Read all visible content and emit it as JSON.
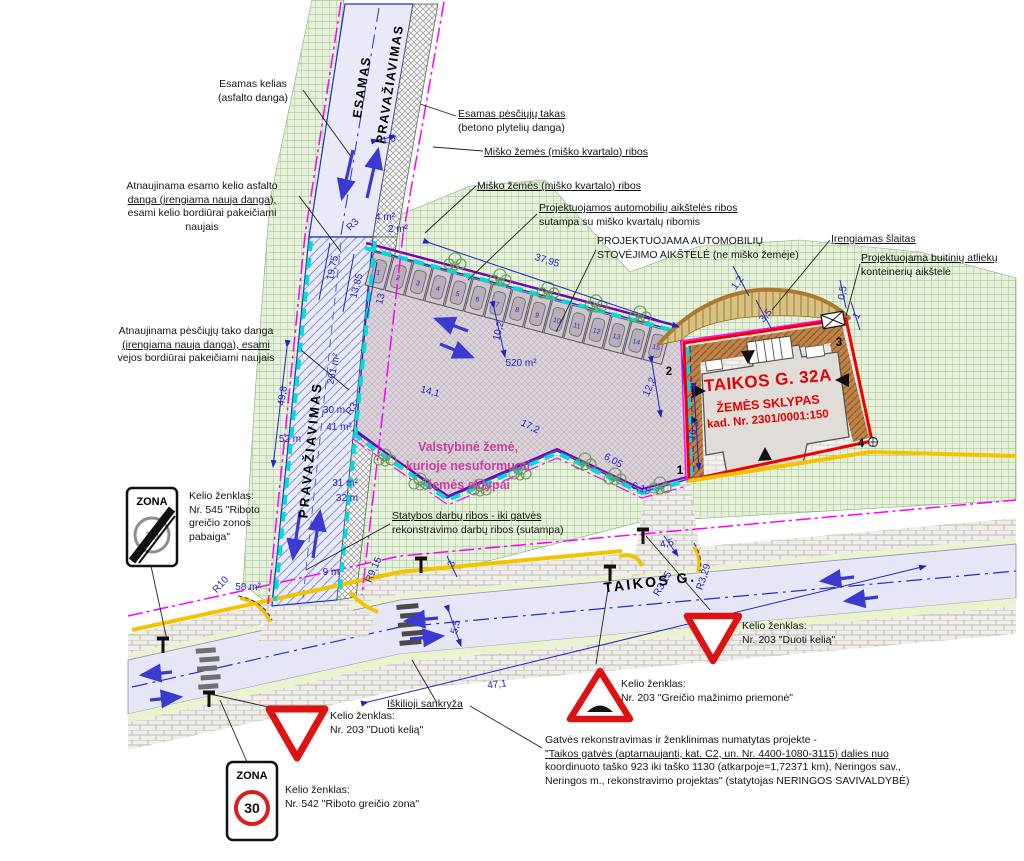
{
  "plot": {
    "title": "TAIKOS G. 32A",
    "subtitle": "ŽEMĖS SKLYPAS",
    "cadastre": "kad. Nr. 2301/0001:150",
    "corner_points": [
      "1",
      "2",
      "3",
      "4"
    ]
  },
  "signs": {
    "zone_end": {
      "title": "ZONA",
      "speed": "30"
    },
    "zone_30": {
      "title": "ZONA",
      "speed": "30"
    }
  },
  "parking": {
    "stall_count": 15,
    "stall_numbers": [
      "1",
      "2",
      "3",
      "4",
      "5",
      "6",
      "7",
      "8",
      "9",
      "10",
      "11",
      "12",
      "13",
      "14",
      "15"
    ],
    "area_label": "520 m²"
  },
  "annotations": [
    {
      "id": "esamas-kelias-label",
      "x": 253,
      "y": 78,
      "align": "center",
      "lines": [
        "Esamas kelias",
        "(asfalto danga)"
      ]
    },
    {
      "id": "esamas-takas-label",
      "x": 458,
      "y": 108,
      "ul": [
        0
      ],
      "lines": [
        "Esamas pėsčiųjų takas",
        "(betono plytelių danga)"
      ]
    },
    {
      "id": "misko-zemes-label-1",
      "x": 484,
      "y": 146,
      "ul": [
        0
      ],
      "lines": [
        "Miško žemės (miško kvartalo) ribos"
      ]
    },
    {
      "id": "misko-zemes-label-2",
      "x": 477,
      "y": 180,
      "ul": [
        0
      ],
      "lines": [
        "Miško žemės (miško kvartalo) ribos"
      ]
    },
    {
      "id": "atnaujinama-kelio-label",
      "x": 202,
      "y": 180,
      "align": "center",
      "ul": [
        1
      ],
      "lines": [
        "Atnaujinama esamo kelio asfalto",
        "danga (įrengiama nauja danga),",
        "esami kelio bordiūrai pakeičiami",
        "naujais"
      ]
    },
    {
      "id": "projektuojamos-ribos-label",
      "x": 539,
      "y": 202,
      "ul": [
        0
      ],
      "lines": [
        "Projektuojamos automobilių aikštelės ribos",
        "sutampa su miško kvartalų ribomis"
      ]
    },
    {
      "id": "projektuojama-aikstele-label",
      "x": 597,
      "y": 235,
      "lines": [
        "PROJEKTUOJAMA AUTOMOBILIŲ",
        "STOVĖJIMO AIKŠTELĖ (ne miško žemėje)"
      ]
    },
    {
      "id": "irengiamas-slaitas-label",
      "x": 831,
      "y": 233,
      "ul": [
        0
      ],
      "lines": [
        "Įrengiamas šlaitas"
      ]
    },
    {
      "id": "buitiniu-atlieku-label",
      "x": 861,
      "y": 252,
      "ul": [
        0
      ],
      "lines": [
        "Projektuojama buitinių atliekų",
        "konteinerių aikštelė"
      ]
    },
    {
      "id": "atnaujinama-tako-label",
      "x": 196,
      "y": 325,
      "align": "center",
      "ul": [
        1
      ],
      "lines": [
        "Atnaujinama pėsčiųjų tako danga",
        "(įrengiama nauja danga), esami",
        "vejos bordiūrai pakeičiami naujais"
      ]
    },
    {
      "id": "statybos-ribos-label",
      "x": 392,
      "y": 510,
      "ul": [
        0
      ],
      "lines": [
        "Statybos darbų ribos - iki gatvės",
        "rekonstravimo darbų ribos (sutampa)"
      ]
    },
    {
      "id": "iskilioji-label",
      "x": 387,
      "y": 698,
      "ul": [
        0
      ],
      "lines": [
        "Iškilioji sankryža"
      ]
    },
    {
      "id": "sign-label-545",
      "x": 189,
      "y": 490,
      "lines": [
        "Kelio ženklas:",
        "Nr. 545 \"Riboto",
        "greičio zonos",
        "pabaiga\""
      ]
    },
    {
      "id": "sign-label-203-left",
      "x": 330,
      "y": 710,
      "lines": [
        "Kelio ženklas:",
        "Nr. 203 \"Duoti kelią\""
      ]
    },
    {
      "id": "sign-label-542",
      "x": 285,
      "y": 784,
      "lines": [
        "Kelio ženklas:",
        "Nr. 542 \"Riboto greičio zona\""
      ]
    },
    {
      "id": "sign-label-203-bump",
      "x": 621,
      "y": 678,
      "lines": [
        "Kelio ženklas:",
        "Nr. 203 \"Greičio mažinimo priemonė\""
      ]
    },
    {
      "id": "sign-label-203-right",
      "x": 742,
      "y": 620,
      "lines": [
        "Kelio ženklas:",
        "Nr. 203 \"Duoti kelią\""
      ]
    },
    {
      "id": "project-note",
      "x": 545,
      "y": 734,
      "ul": [
        1
      ],
      "lines": [
        "Gatvės rekonstravimas ir ženklinimas numatytas projekte -",
        "\"Taikos gatvės (aptarnaujanti, kat. C2, un. Nr. 4400-1080-3115) dalies nuo",
        "koordinuoto taško 923 iki taško 1130 (atkarpoje=1,72371 km), Neringos sav.,",
        "Neringos m., rekonstravimo projektas\" (statytojas NERINGOS SAVIVALDYBĖ)"
      ]
    },
    {
      "id": "valstybine-zeme-label",
      "x": 468,
      "y": 438,
      "align": "center",
      "cls": "pink",
      "lines": [
        "Valstybinė žemė,",
        "kurioje nesuformuoti",
        "žemės sklypai"
      ]
    },
    {
      "id": "plot-title",
      "x": 768,
      "y": 381,
      "align": "center",
      "r": -5,
      "cls": "red1",
      "lines": [
        "TAIKOS G. 32A"
      ]
    },
    {
      "id": "plot-subtitle",
      "x": 768,
      "y": 404,
      "align": "center",
      "r": -5,
      "cls": "red2",
      "lines": [
        "ŽEMĖS SKLYPAS"
      ]
    },
    {
      "id": "plot-cadastre",
      "x": 768,
      "y": 420,
      "align": "center",
      "r": -5,
      "cls": "red3",
      "lines": [
        "kad. Nr. 2301/0001:150"
      ]
    },
    {
      "id": "roadname-esamas",
      "x": 362,
      "y": 87,
      "align": "center",
      "r": -81,
      "cls": "roadname",
      "lines": [
        "ESAMAS"
      ]
    },
    {
      "id": "roadname-prav-top",
      "x": 390,
      "y": 84,
      "align": "center",
      "r": -81,
      "cls": "roadname",
      "lines": [
        "PRAVAŽIAVIMAS"
      ]
    },
    {
      "id": "roadname-prav-bottom",
      "x": 311,
      "y": 450,
      "align": "center",
      "r": -84,
      "cls": "roadname2",
      "lines": [
        "PRAVAŽIAVIMAS"
      ]
    },
    {
      "id": "street-name",
      "x": 650,
      "y": 582,
      "align": "center",
      "r": -7,
      "cls": "streetname",
      "lines": [
        "TAIKOS G."
      ]
    }
  ],
  "dimensions": [
    {
      "t": "19,75",
      "x": 333,
      "y": 268,
      "r": -78
    },
    {
      "t": "13,85",
      "x": 357,
      "y": 286,
      "r": -75
    },
    {
      "t": "13",
      "x": 381,
      "y": 299,
      "r": -75
    },
    {
      "t": "R3",
      "x": 353,
      "y": 225,
      "r": -45
    },
    {
      "t": "4 m²",
      "x": 385,
      "y": 211,
      "r": 0
    },
    {
      "t": "2 m²",
      "x": 398,
      "y": 223,
      "r": 0
    },
    {
      "t": "1,5",
      "x": 389,
      "y": 140,
      "r": -12
    },
    {
      "t": "37,95",
      "x": 547,
      "y": 261,
      "r": 17
    },
    {
      "t": "261 m²",
      "x": 334,
      "y": 369,
      "r": -78
    },
    {
      "t": "49,8",
      "x": 283,
      "y": 396,
      "r": -81
    },
    {
      "t": "52 m",
      "x": 290,
      "y": 433,
      "r": 0
    },
    {
      "t": "30 m",
      "x": 334,
      "y": 404,
      "r": 0
    },
    {
      "t": "41 m²",
      "x": 339,
      "y": 421,
      "r": 0
    },
    {
      "t": "R3",
      "x": 352,
      "y": 409,
      "r": -55
    },
    {
      "t": "31 m²",
      "x": 345,
      "y": 477,
      "r": 0
    },
    {
      "t": "32 m",
      "x": 347,
      "y": 492,
      "r": 0
    },
    {
      "t": "9 m",
      "x": 331,
      "y": 566,
      "r": 0
    },
    {
      "t": "58 m²",
      "x": 248,
      "y": 581,
      "r": 0
    },
    {
      "t": "R10",
      "x": 221,
      "y": 585,
      "r": -48
    },
    {
      "t": "R9,15",
      "x": 374,
      "y": 570,
      "r": -66
    },
    {
      "t": "14,1",
      "x": 430,
      "y": 392,
      "r": 15
    },
    {
      "t": "17,2",
      "x": 530,
      "y": 427,
      "r": 26
    },
    {
      "t": "10,2",
      "x": 499,
      "y": 331,
      "r": -76
    },
    {
      "t": "520 m²",
      "x": 521,
      "y": 357,
      "r": 0
    },
    {
      "t": "12,2",
      "x": 650,
      "y": 387,
      "r": -67
    },
    {
      "t": "6,05",
      "x": 613,
      "y": 461,
      "r": 29
    },
    {
      "t": "6,15",
      "x": 641,
      "y": 489,
      "r": 20
    },
    {
      "t": "16,3",
      "x": 694,
      "y": 431,
      "r": -76
    },
    {
      "t": "4,5",
      "x": 667,
      "y": 544,
      "r": -12
    },
    {
      "t": "R3,15",
      "x": 663,
      "y": 584,
      "r": -60
    },
    {
      "t": "R3,29",
      "x": 704,
      "y": 577,
      "r": -72
    },
    {
      "t": "3",
      "x": 452,
      "y": 564,
      "r": -70
    },
    {
      "t": "5,5",
      "x": 456,
      "y": 627,
      "r": -76
    },
    {
      "t": "47,1",
      "x": 497,
      "y": 685,
      "r": -6
    },
    {
      "t": "1,2",
      "x": 738,
      "y": 283,
      "r": -55
    },
    {
      "t": "3,5",
      "x": 766,
      "y": 316,
      "r": -48
    },
    {
      "t": "0,5",
      "x": 843,
      "y": 293,
      "r": -80
    },
    {
      "t": "1",
      "x": 857,
      "y": 316,
      "r": -62
    }
  ],
  "points": [
    {
      "t": "1",
      "x": 680,
      "y": 464
    },
    {
      "t": "2",
      "x": 669,
      "y": 365
    },
    {
      "t": "3",
      "x": 839,
      "y": 336
    },
    {
      "t": "4",
      "x": 861,
      "y": 437
    }
  ]
}
